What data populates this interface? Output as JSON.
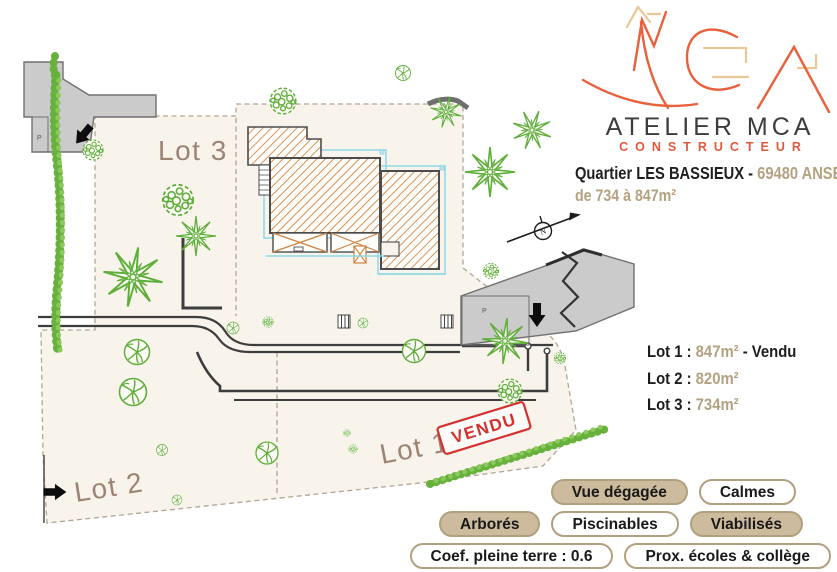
{
  "brand": {
    "logo_text": "MCA",
    "name": "ATELIER MCA",
    "subtitle": "CONSTRUCTEUR",
    "orange": "#e8603c",
    "tan_accent": "#eac795",
    "dark": "#3c3c3c"
  },
  "header": {
    "district": "Quartier LES BASSIEUX - ",
    "city": "69480 ANSE",
    "size_range": "de 734 à 847m²",
    "tan": "#b3a280"
  },
  "lots_summary": [
    {
      "label": "Lot 1 : ",
      "area": "847m²",
      "suffix": " - Vendu"
    },
    {
      "label": "Lot 2 : ",
      "area": "820m²",
      "suffix": ""
    },
    {
      "label": "Lot 3 : ",
      "area": "734m²",
      "suffix": ""
    }
  ],
  "plan": {
    "lot1": "Lot 1",
    "lot2": "Lot 2",
    "lot3": "Lot 3",
    "sold_stamp": "VENDU",
    "parking": "P",
    "north": "N",
    "label_color": "#9c8373",
    "sold_color": "#d43030",
    "green": "#5fae3a",
    "parcel_cream": "#f8f4ec",
    "hatch_orange": "#cd8240",
    "pool_cyan": "#8ed8e8",
    "road_gray": "#cbcbcb"
  },
  "badges": {
    "fill_color": "#cdbb9d",
    "border_color": "#b1a07f",
    "rows": [
      [
        {
          "label": "Vue dégagée",
          "filled": true
        },
        {
          "label": "Calmes",
          "filled": false
        }
      ],
      [
        {
          "label": "Arborés",
          "filled": true
        },
        {
          "label": "Piscinables",
          "filled": false
        },
        {
          "label": "Viabilisés",
          "filled": true
        }
      ],
      [
        {
          "label": "Coef. pleine terre : 0.6",
          "filled": false
        },
        {
          "label": "Prox. écoles & collège",
          "filled": false
        }
      ]
    ]
  }
}
